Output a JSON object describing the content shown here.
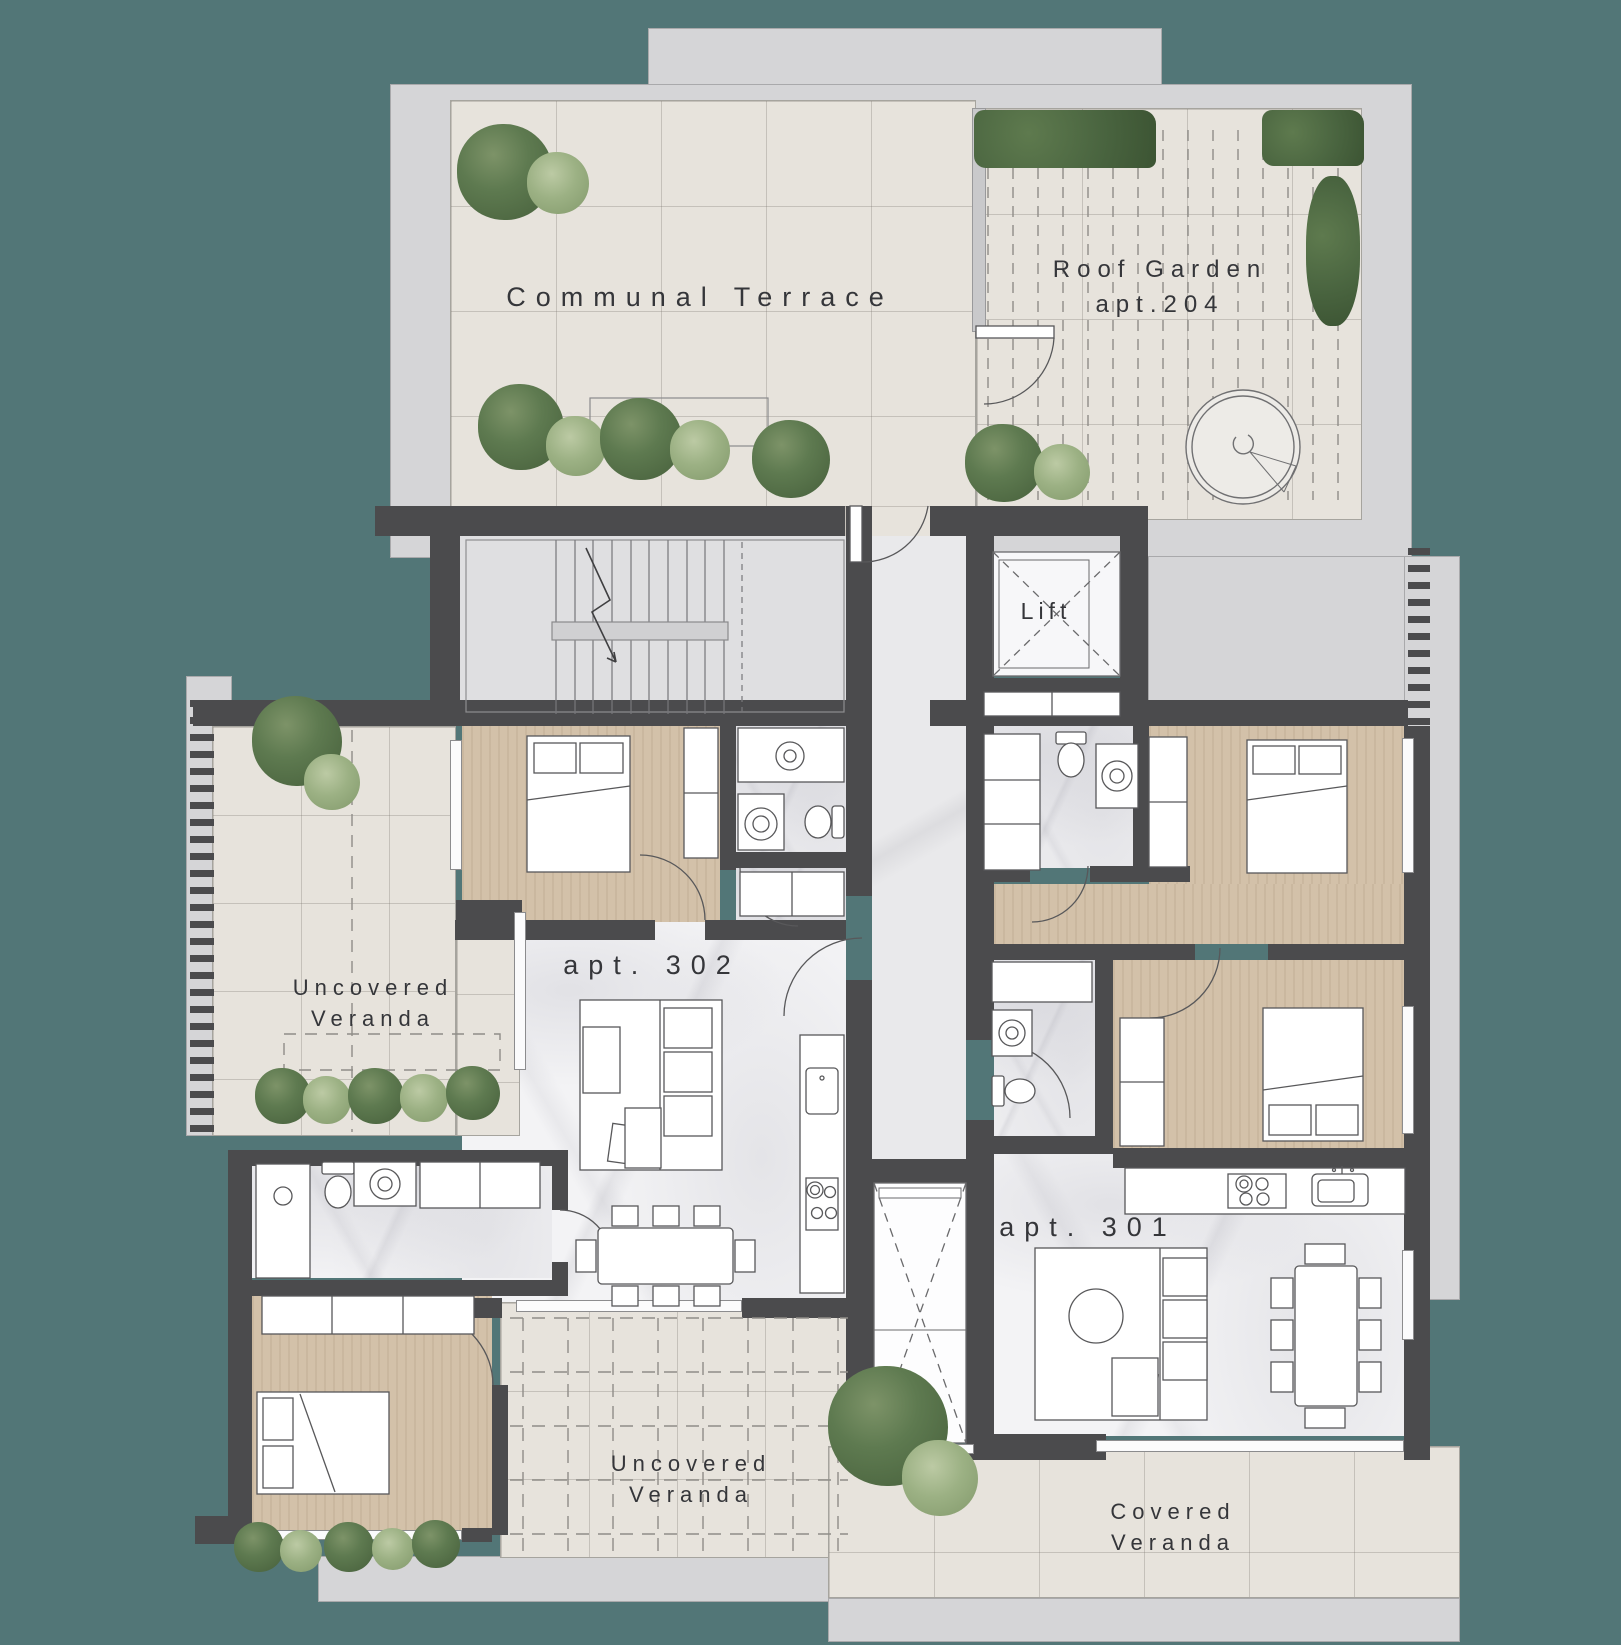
{
  "palette": {
    "background": "#527677",
    "wall": "#4b4b4d",
    "slab": "#d5d5d7",
    "tile": "#e7e3dc",
    "wood": "#d3c1a9",
    "marble": "#f3f3f5",
    "foliage_dark": "#55704a",
    "foliage_light": "#94ab7d"
  },
  "rooms": {
    "communal_terrace": {
      "name": "Communal Terrace"
    },
    "roof_garden": {
      "name": "Roof Garden",
      "apartment": "apt.204"
    },
    "lift": {
      "name": "Lift"
    },
    "apt_302": {
      "name": "apt. 302"
    },
    "apt_301": {
      "name": "apt. 301"
    },
    "veranda_left": {
      "line1": "Uncovered",
      "line2": "Veranda"
    },
    "veranda_bottom": {
      "line1": "Uncovered",
      "line2": "Veranda"
    },
    "veranda_covered": {
      "line1": "Covered",
      "line2": "Veranda"
    }
  }
}
